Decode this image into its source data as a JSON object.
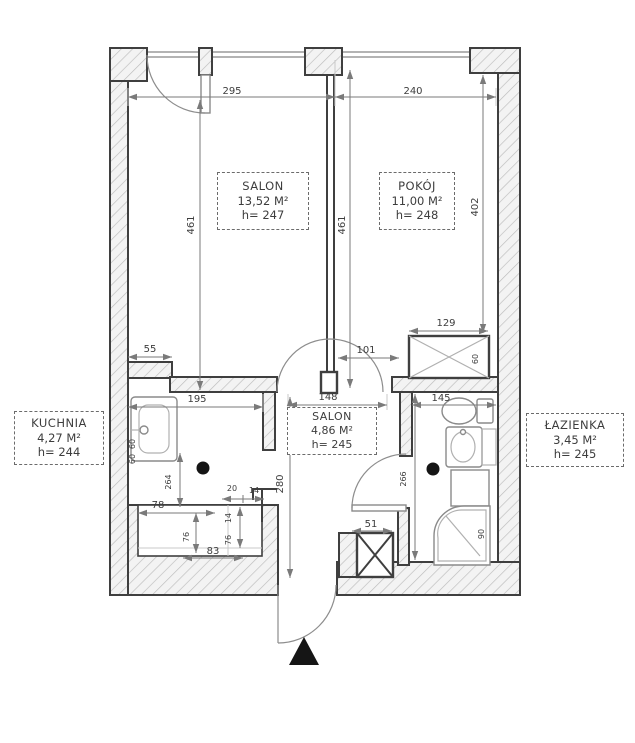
{
  "rooms": [
    {
      "name": "SALON",
      "area": "13,52 M²",
      "height": "h= 247"
    },
    {
      "name": "POKÓJ",
      "area": "11,00 M²",
      "height": "h= 248"
    },
    {
      "name": "SALON",
      "area": "4,86 M²",
      "height": "h= 245"
    },
    {
      "name": "KUCHNIA",
      "area": "4,27 M²",
      "height": "h= 244"
    },
    {
      "name": "ŁAZIENKA",
      "area": "3,45 M²",
      "height": "h= 245"
    }
  ],
  "dims": {
    "top_salon": "295",
    "top_pokoj": "240",
    "salon_depth": "461",
    "pokoj_depth": "461",
    "right_side": "402",
    "kitchen_stub": "55",
    "kitchen_width": "195",
    "hall_width": "148",
    "bathroom_width": "145",
    "pokoj_door": "101",
    "wardrobe_width": "129",
    "wardrobe_depth": "60",
    "hall_depth": "280",
    "kitchen_depth": "264",
    "bathroom_depth": "266",
    "shaft_width": "51",
    "recess_top": "78",
    "recess_side": "76",
    "recess_bottom": "83",
    "step_20": "20",
    "step_14": "14",
    "step_76": "76",
    "step_14b": "14",
    "sink_60a": "60",
    "sink_60b": "60",
    "shower_90": "90"
  },
  "colors": {
    "wall_outline": "#3f3f3f",
    "hatch_line": "#bcbcbc",
    "hatch_fill": "#f3f3f3",
    "dim_line": "#7a7a7a",
    "text": "#3d3d3d",
    "fixture": "#8a8a8a",
    "marker": "#151515",
    "window": "#9a9a9a"
  }
}
